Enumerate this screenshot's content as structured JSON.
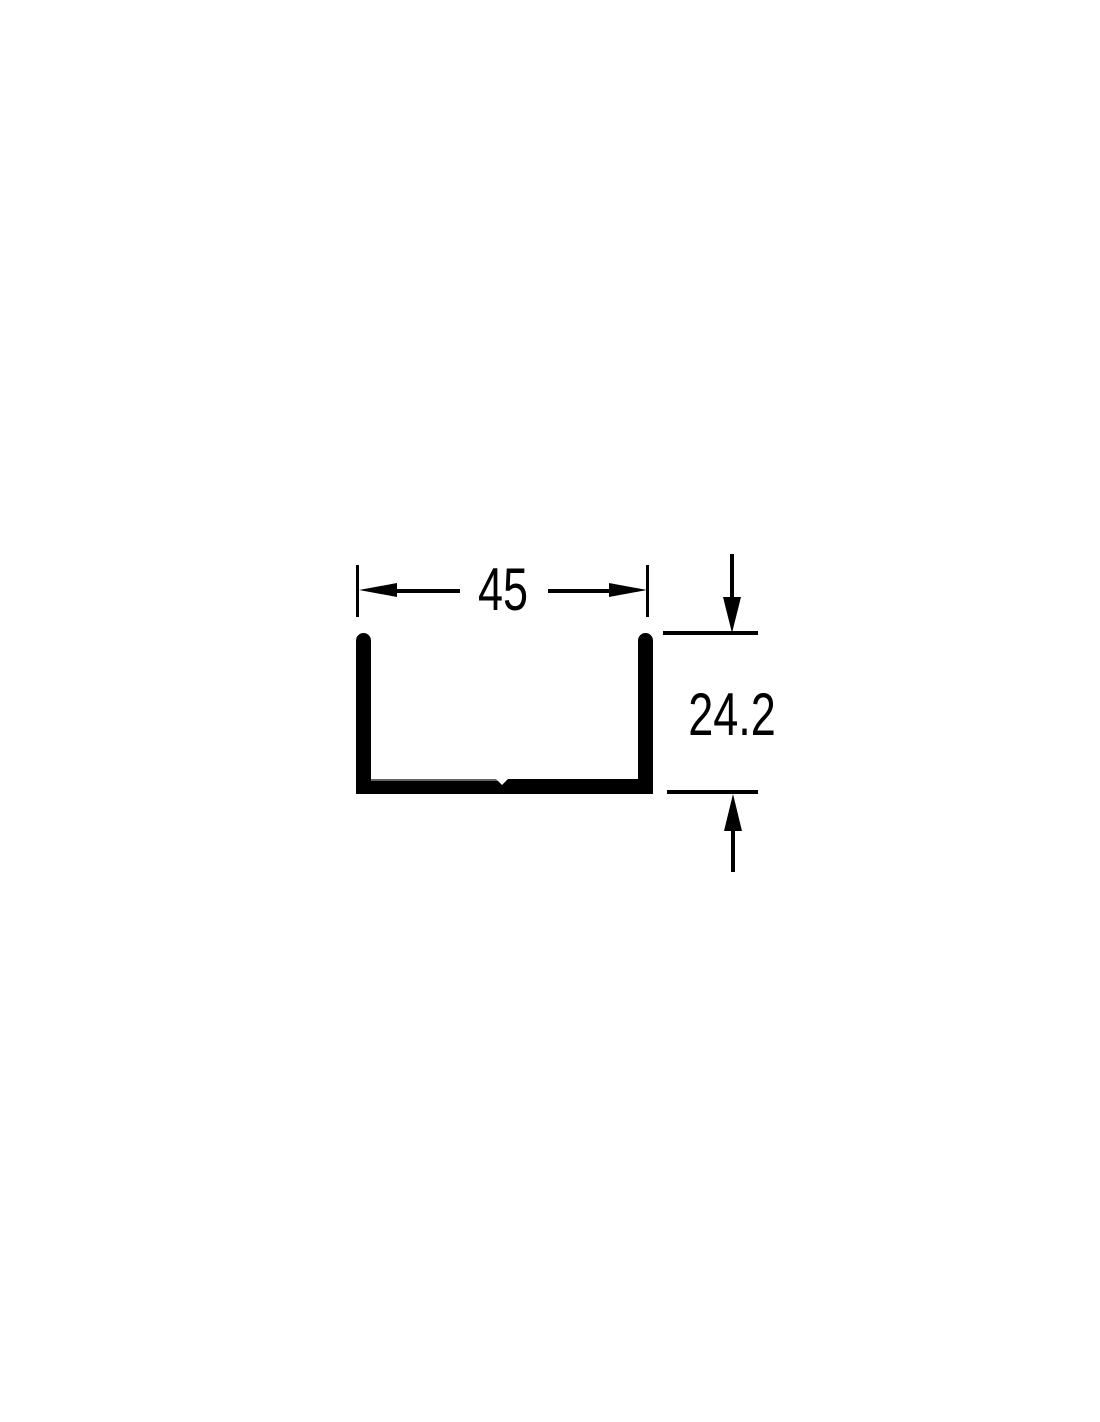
{
  "canvas": {
    "width_px": 1100,
    "height_px": 1422,
    "background": "#ffffff",
    "ink": "#000000"
  },
  "drawing": {
    "kind": "U-channel profile cross-section",
    "dimensions": {
      "width": {
        "label": "45",
        "orientation": "horizontal"
      },
      "height": {
        "label": "24.2",
        "orientation": "vertical"
      }
    }
  }
}
